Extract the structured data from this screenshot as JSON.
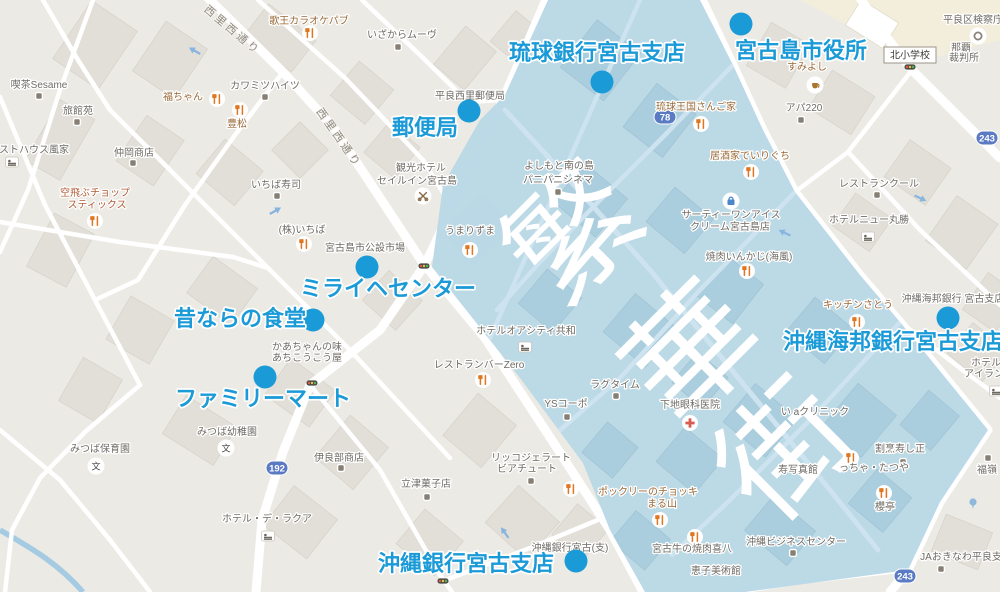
{
  "district_overlay": {
    "label": "繁華街",
    "label_color": "#ffffff",
    "region_color": "#b9d7e6"
  },
  "accent_color": "#1b9ad8",
  "annotations": [
    {
      "label": "琉球銀行宮古支店"
    },
    {
      "label": "宮古島市役所"
    },
    {
      "label": "郵便局"
    },
    {
      "label": "ミライヘセンター"
    },
    {
      "label": "昔ならの食堂"
    },
    {
      "label": "ファミリーマート"
    },
    {
      "label": "沖縄海邦銀行宮古支店"
    },
    {
      "label": "沖縄銀行宮古支店"
    }
  ],
  "road_labels": [
    "西里西通り",
    "西里西通り"
  ],
  "route_shields": [
    "78",
    "192",
    "243",
    "243"
  ],
  "school_box_label": "北小学校",
  "icons": {
    "school_glyph": "文"
  },
  "poi": [
    {
      "text": "喫茶Sesame"
    },
    {
      "text": "旅館苑"
    },
    {
      "text": "ストハウス風家"
    },
    {
      "text": "空飛ぶチョップ"
    },
    {
      "text": "スティックス"
    },
    {
      "text": "仲岡商店"
    },
    {
      "text": "福ちゃん"
    },
    {
      "text": "豊松"
    },
    {
      "text": "カワミツハイツ"
    },
    {
      "text": "歌王カラオケパブ"
    },
    {
      "text": "いざからムーヴ"
    },
    {
      "text": "いちば寿司"
    },
    {
      "text": "平良西里郵便局"
    },
    {
      "text": "観光ホテル"
    },
    {
      "text": "セイルイン宮古島"
    },
    {
      "text": "(株)いちば"
    },
    {
      "text": "宮古島市公設市場"
    },
    {
      "text": "かあちゃんの味"
    },
    {
      "text": "あちこうこう屋"
    },
    {
      "text": "みつば幼稚園"
    },
    {
      "text": "みつば保育園"
    },
    {
      "text": "伊良部商店"
    },
    {
      "text": "ホテル・デ・ラクア"
    },
    {
      "text": "立津菓子店"
    },
    {
      "text": "リッコジェラート"
    },
    {
      "text": "ビアチュート"
    },
    {
      "text": "沖縄銀行宮古(支)"
    },
    {
      "text": "うまりずま"
    },
    {
      "text": "よしもと南の島"
    },
    {
      "text": "パニパニシネマ"
    },
    {
      "text": "ホテルオアシティ共和"
    },
    {
      "text": "レストランバーZero"
    },
    {
      "text": "ラグタイム"
    },
    {
      "text": "YSコーポ"
    },
    {
      "text": "下地眼科医院"
    },
    {
      "text": "い aクリニック"
    },
    {
      "text": "寿写真館"
    },
    {
      "text": "っちゃ・たつや"
    },
    {
      "text": "割烹寿し正"
    },
    {
      "text": "櫻亭"
    },
    {
      "text": "沖縄ビジネスセンター"
    },
    {
      "text": "宮古牛の焼肉喜八"
    },
    {
      "text": "恵子美術館"
    },
    {
      "text": "JAおきなわ平良支店"
    },
    {
      "text": "福嶺"
    },
    {
      "text": "ホテル"
    },
    {
      "text": "アイラン"
    },
    {
      "text": "ホテルニュー丸勝"
    },
    {
      "text": "レストランクール"
    },
    {
      "text": "居酒家でいりぐち"
    },
    {
      "text": "琉球王国さんご家"
    },
    {
      "text": "アパ220"
    },
    {
      "text": "すみよし"
    },
    {
      "text": "平良区検察庁"
    },
    {
      "text": "那覇"
    },
    {
      "text": "裁判所"
    },
    {
      "text": "サーティーワンアイス"
    },
    {
      "text": "クリーム宮古島店"
    },
    {
      "text": "焼肉いんかじ(海風)"
    },
    {
      "text": "キッチンさとう"
    },
    {
      "text": "沖縄海邦銀行 宮古支店"
    },
    {
      "text": "ポックリーのチョッキ"
    },
    {
      "text": "まる山"
    }
  ]
}
